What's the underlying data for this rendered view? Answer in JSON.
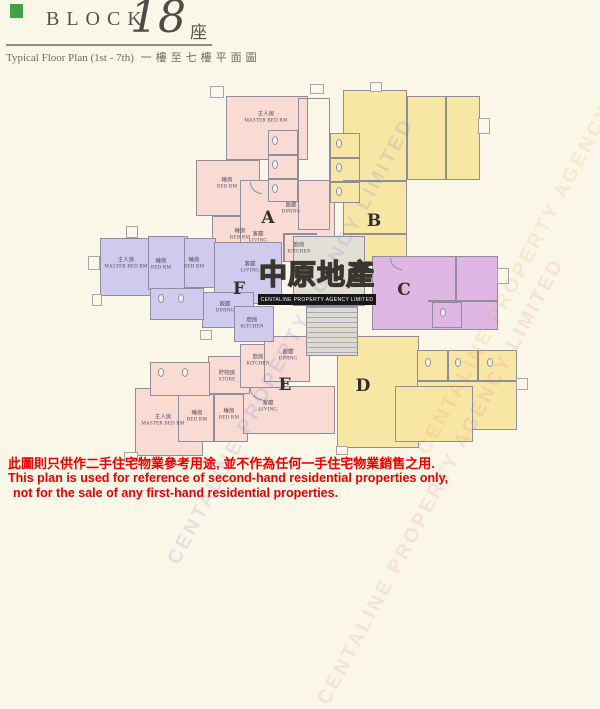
{
  "header": {
    "block_label": "BLOCK",
    "block_number": "18",
    "block_suffix": "座",
    "subtitle_en": "Typical Floor Plan (1st - 7th)",
    "subtitle_zh": "一樓至七樓平面圖"
  },
  "logo": {
    "name_zh": "中原地產",
    "name_en": "CENTALINE PROPERTY AGENCY LIMITED"
  },
  "watermark": {
    "text": "CENTALINE PROPERTY AGENCY LIMITED"
  },
  "colors": {
    "unit_pink": "#f9dbd3",
    "unit_yellow": "#f7e6a4",
    "unit_lavender": "#cfcaee",
    "unit_orchid": "#e0b6e4",
    "block_marker_green": "#44a048",
    "disclaimer_red": "#e80000"
  },
  "plan": {
    "units": [
      {
        "label": "A",
        "color": "#f9dbd3"
      },
      {
        "label": "B",
        "color": "#f7e6a4"
      },
      {
        "label": "C",
        "color": "#e0b6e4"
      },
      {
        "label": "D",
        "color": "#f7e6a4"
      },
      {
        "label": "E",
        "color": "#f9dbd3"
      },
      {
        "label": "F",
        "color": "#cfcaee"
      }
    ],
    "room_labels": [
      {
        "unit": "A",
        "zh": "主人房",
        "en": "MASTER BED RM"
      },
      {
        "unit": "A",
        "zh": "睡房",
        "en": "BED RM"
      },
      {
        "unit": "A",
        "zh": "睡房",
        "en": "BED RM"
      },
      {
        "unit": "A",
        "zh": "飯廳",
        "en": "DINING"
      },
      {
        "unit": "A",
        "zh": "客廳",
        "en": "LIVING"
      },
      {
        "unit": "A",
        "zh": "廚房",
        "en": "KITCHEN"
      },
      {
        "unit": "F",
        "zh": "主人房",
        "en": "MASTER BED RM"
      },
      {
        "unit": "F",
        "zh": "睡房",
        "en": "BED RM"
      },
      {
        "unit": "F",
        "zh": "睡房",
        "en": "BED RM"
      },
      {
        "unit": "F",
        "zh": "客廳",
        "en": "LIVING"
      },
      {
        "unit": "F",
        "zh": "飯廳",
        "en": "DINING"
      },
      {
        "unit": "F",
        "zh": "廚房",
        "en": "KITCHEN"
      },
      {
        "unit": "E",
        "zh": "廚房",
        "en": "KITCHEN"
      },
      {
        "unit": "E",
        "zh": "貯物房",
        "en": "STORE"
      },
      {
        "unit": "E",
        "zh": "飯廳",
        "en": "DINING"
      },
      {
        "unit": "E",
        "zh": "客廳",
        "en": "LIVING"
      },
      {
        "unit": "E",
        "zh": "睡房",
        "en": "BED RM"
      },
      {
        "unit": "E",
        "zh": "睡房",
        "en": "BED RM"
      },
      {
        "unit": "E",
        "zh": "主人房",
        "en": "MASTER BED RM"
      }
    ]
  },
  "disclaimer": {
    "line1_zh": "此圖則只供作二手住宅物業參考用途, 並不作為任何一手住宅物業銷售之用.",
    "line2_en": "This plan is used for reference of second-hand residential properties only,",
    "line3_en": "not for the sale of any first-hand residential properties."
  }
}
